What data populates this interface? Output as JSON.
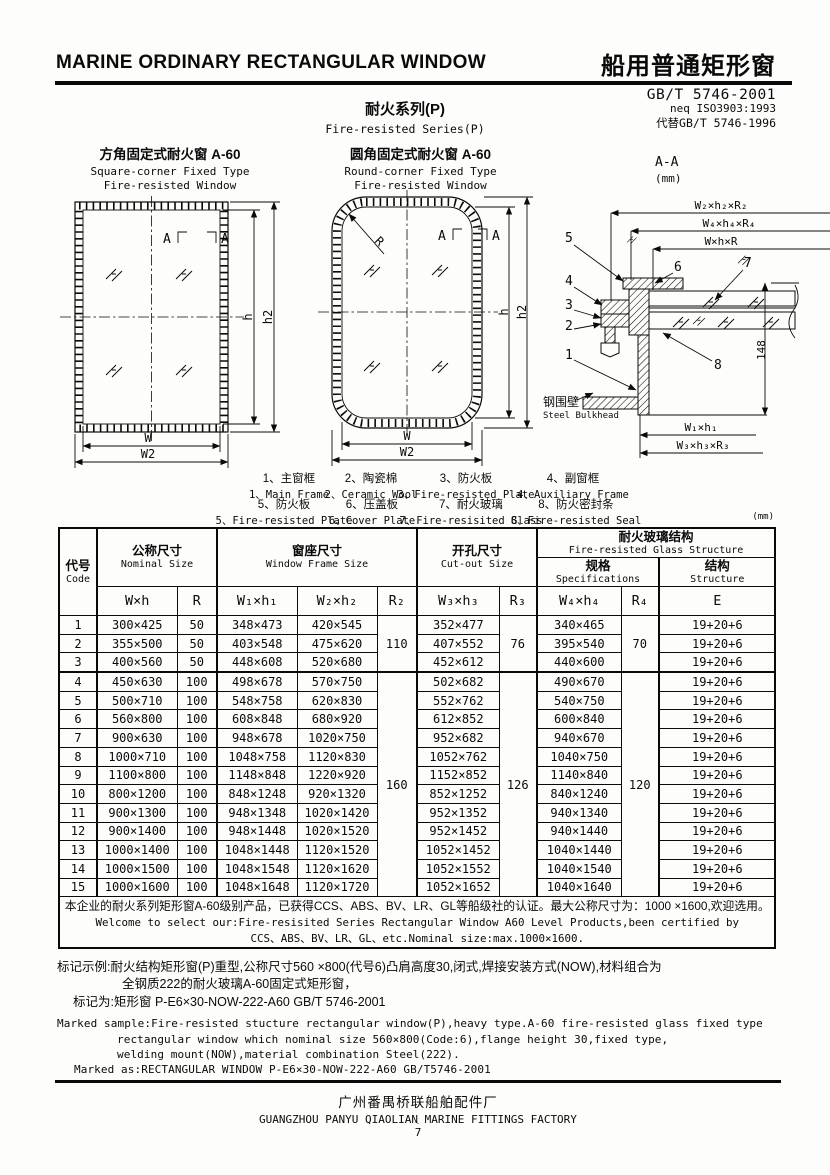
{
  "header": {
    "title_en": "MARINE ORDINARY RECTANGULAR WINDOW",
    "title_zh": "船用普通矩形窗",
    "standard": "GB/T 5746-2001",
    "standard_neq": "neq ISO3903:1993",
    "standard_replaces": "代替GB/T 5746-1996"
  },
  "series": {
    "zh": "耐火系列(P)",
    "en": "Fire-resisted Series(P)"
  },
  "drawings": {
    "square": {
      "title_zh": "方角固定式耐火窗  A-60",
      "title_en1": "Square-corner Fixed Type",
      "title_en2": "Fire-resisted Window",
      "dim_w": "W",
      "dim_w2": "W2",
      "dim_h": "h",
      "dim_h2": "h2",
      "section_mark": "A"
    },
    "round": {
      "title_zh": "圆角固定式耐火窗  A-60",
      "title_en1": "Round-corner Fixed Type",
      "title_en2": "Fire-resisted Window",
      "dim_w": "W",
      "dim_w2": "W2",
      "dim_h": "h",
      "dim_h2": "h2",
      "dim_r": "R",
      "section_mark": "A"
    },
    "section": {
      "title": "A-A",
      "unit": "(mm)",
      "dim_w2h2r2": "W₂×h₂×R₂",
      "dim_w4h4r4": "W₄×h₄×R₄",
      "dim_whr": "W×h×R",
      "dim_w1h1": "W₁×h₁",
      "dim_w3h3r3": "W₃×h₃×R₃",
      "dim_148": "148",
      "bulkhead_zh": "钢围壁",
      "bulkhead_en": "Steel Bulkhead",
      "callouts": [
        "1",
        "2",
        "3",
        "4",
        "5",
        "6",
        "7",
        "8"
      ]
    }
  },
  "legend": {
    "items": [
      {
        "zh": "1、主窗框",
        "en": "1、Main Frame"
      },
      {
        "zh": "2、陶瓷棉",
        "en": "2、Ceramic Wool"
      },
      {
        "zh": "3、防火板",
        "en": "3、Fire-resisted Plate"
      },
      {
        "zh": "4、副窗框",
        "en": "4、Auxiliary Frame"
      },
      {
        "zh": "5、防火板",
        "en": "5、Fire-resisted Plate"
      },
      {
        "zh": "6、压盖板",
        "en": "6、Cover Plate"
      },
      {
        "zh": "7、耐火玻璃",
        "en": "7、Fire-resisited Glass"
      },
      {
        "zh": "8、防火密封条",
        "en": "8、Fire-resisted Seal"
      }
    ]
  },
  "table": {
    "unit": "(mm)",
    "headers": {
      "code_zh": "代号",
      "code_en": "Code",
      "nominal_zh": "公称尺寸",
      "nominal_en": "Nominal Size",
      "frame_zh": "窗座尺寸",
      "frame_en": "Window Frame Size",
      "cutout_zh": "开孔尺寸",
      "cutout_en": "Cut-out Size",
      "glass_zh": "耐火玻璃结构",
      "glass_en": "Fire-resisted Glass Structure",
      "spec_zh": "规格",
      "spec_en": "Specifications",
      "struct_zh": "结构",
      "struct_en": "Structure",
      "wh": "W×h",
      "r": "R",
      "w1h1": "W₁×h₁",
      "w2h2": "W₂×h₂",
      "r2": "R₂",
      "w3h3": "W₃×h₃",
      "r3": "R₃",
      "w4h4": "W₄×h₄",
      "r4": "R₄",
      "e": "E"
    },
    "rows": [
      [
        "1",
        "300×425",
        "50",
        "348×473",
        "420×545",
        "352×477",
        "340×465",
        "19+20+6"
      ],
      [
        "2",
        "355×500",
        "50",
        "403×548",
        "475×620",
        "407×552",
        "395×540",
        "19+20+6"
      ],
      [
        "3",
        "400×560",
        "50",
        "448×608",
        "520×680",
        "452×612",
        "440×600",
        "19+20+6"
      ],
      [
        "4",
        "450×630",
        "100",
        "498×678",
        "570×750",
        "502×682",
        "490×670",
        "19+20+6"
      ],
      [
        "5",
        "500×710",
        "100",
        "548×758",
        "620×830",
        "552×762",
        "540×750",
        "19+20+6"
      ],
      [
        "6",
        "560×800",
        "100",
        "608×848",
        "680×920",
        "612×852",
        "600×840",
        "19+20+6"
      ],
      [
        "7",
        "900×630",
        "100",
        "948×678",
        "1020×750",
        "952×682",
        "940×670",
        "19+20+6"
      ],
      [
        "8",
        "1000×710",
        "100",
        "1048×758",
        "1120×830",
        "1052×762",
        "1040×750",
        "19+20+6"
      ],
      [
        "9",
        "1100×800",
        "100",
        "1148×848",
        "1220×920",
        "1152×852",
        "1140×840",
        "19+20+6"
      ],
      [
        "10",
        "800×1200",
        "100",
        "848×1248",
        "920×1320",
        "852×1252",
        "840×1240",
        "19+20+6"
      ],
      [
        "11",
        "900×1300",
        "100",
        "948×1348",
        "1020×1420",
        "952×1352",
        "940×1340",
        "19+20+6"
      ],
      [
        "12",
        "900×1400",
        "100",
        "948×1448",
        "1020×1520",
        "952×1452",
        "940×1440",
        "19+20+6"
      ],
      [
        "13",
        "1000×1400",
        "100",
        "1048×1448",
        "1120×1520",
        "1052×1452",
        "1040×1440",
        "19+20+6"
      ],
      [
        "14",
        "1000×1500",
        "100",
        "1048×1548",
        "1120×1620",
        "1052×1552",
        "1040×1540",
        "19+20+6"
      ],
      [
        "15",
        "1000×1600",
        "100",
        "1048×1648",
        "1120×1720",
        "1052×1652",
        "1040×1640",
        "19+20+6"
      ]
    ],
    "r2_groups": [
      {
        "start": 1,
        "span": 3,
        "value": "110"
      },
      {
        "start": 4,
        "span": 12,
        "value": "160"
      }
    ],
    "r3_groups": [
      {
        "start": 1,
        "span": 3,
        "value": "76"
      },
      {
        "start": 4,
        "span": 12,
        "value": "126"
      }
    ],
    "r4_groups": [
      {
        "start": 1,
        "span": 3,
        "value": "70"
      },
      {
        "start": 4,
        "span": 12,
        "value": "120"
      }
    ],
    "note_lines": [
      "本企业的耐火系列矩形窗A-60级别产品，已获得CCS、ABS、BV、LR、GL等船级社的认证。最大公称尺寸为：1000 ×1600,欢迎选用。",
      "Welcome to select our:Fire-resisited Series Rectangular Window A60 Level Products,been certified by",
      "CCS、ABS、BV、LR、GL、etc.Nominal size:max.1000×1600."
    ]
  },
  "marking": {
    "zh1": "标记示例:耐火结构矩形窗(P)重型,公称尺寸560 ×800(代号6)凸肩高度30,闭式,焊接安装方式(NOW),材料组合为",
    "zh2": "全钢质222的耐火玻璃A-60固定式矩形窗，",
    "zh3": "标记为:矩形窗  P-E6×30-NOW-222-A60  GB/T 5746-2001",
    "en1": "Marked sample:Fire-resisted stucture rectangular window(P),heavy type.A-60 fire-resisted glass fixed type",
    "en2": "rectangular window which nominal size 560×800(Code:6),flange height 30,fixed type,",
    "en3": "welding mount(NOW),material combination Steel(222).",
    "en4": "Marked as:RECTANGULAR WINDOW  P-E6×30-NOW-222-A60  GB/T5746-2001"
  },
  "footer": {
    "factory_zh": "广州番禺桥联船舶配件厂",
    "factory_en": "GUANGZHOU PANYU QIAOLIAN MARINE FITTINGS FACTORY",
    "page_dot": "·",
    "page": "7"
  }
}
